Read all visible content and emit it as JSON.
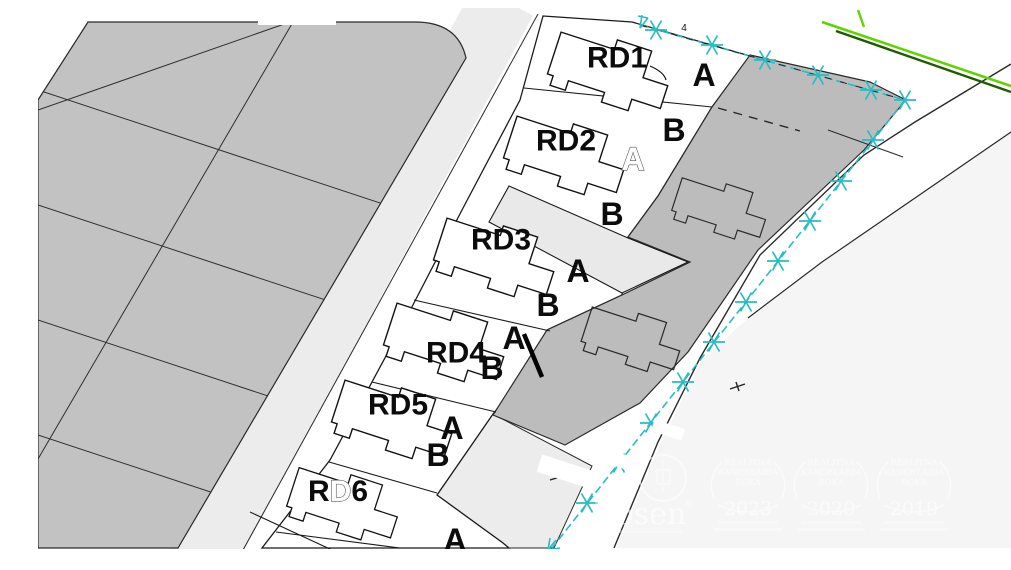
{
  "map": {
    "lot_labels": [
      "RD1",
      "RD2",
      "RD3",
      "RD4",
      "RD5",
      "RD6"
    ],
    "rd6_glyphs": {
      "r": "R",
      "d": "D",
      "six": "6"
    },
    "unit_labels": {
      "rd1_a": "A",
      "rd2_b": "B",
      "rd2_a_ghost": "A",
      "rd2_b2": "B",
      "rd3_a": "A",
      "rd3_b": "B",
      "rd4_a": "A",
      "rd4_b": "B",
      "rd5_a": "A",
      "rd5_b": "B",
      "rd6_a": "A"
    },
    "annotations": {
      "marker_number": "4"
    }
  },
  "watermark": {
    "brand": "Bosen",
    "registered_mark": "®",
    "award_title_lines": [
      "REALITNÁ",
      "KANCELÁRIA",
      "ROKA"
    ],
    "award_years": [
      "2023",
      "2020",
      "2019"
    ]
  },
  "colors": {
    "parcel_fill_left": "#c2c2c2",
    "parcel_fill_right": "#bcbcbc",
    "road_fill": "#ececec",
    "branch_road_fill": "#e9e9e9",
    "corner_area_fill": "#f5f5f5",
    "outline": "#1a1a1a",
    "utility_line_cyan": "#29bcc1",
    "boundary_green_bright": "#5fd400",
    "boundary_green_dark": "#1d5c00"
  }
}
